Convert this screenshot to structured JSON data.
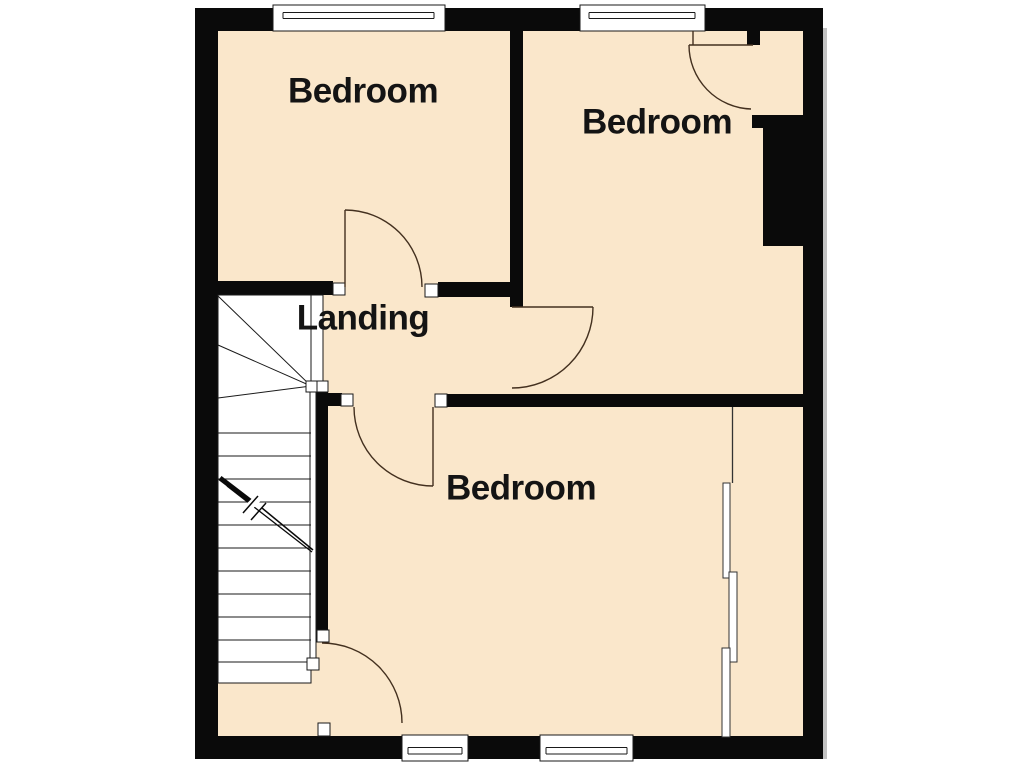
{
  "plan": {
    "title": "first-floor plan",
    "rooms": [
      {
        "id": "bedroom-top-left",
        "label": "Bedroom"
      },
      {
        "id": "bedroom-top-right",
        "label": "Bedroom"
      },
      {
        "id": "landing",
        "label": "Landing"
      },
      {
        "id": "bedroom-bottom",
        "label": "Bedroom"
      }
    ],
    "colors": {
      "floor": "#FAE7CB",
      "wall": "#0A0A0A",
      "door_arc": "#43301F",
      "detail_line": "#1A1A1A",
      "background": "#FFFFFF"
    }
  }
}
